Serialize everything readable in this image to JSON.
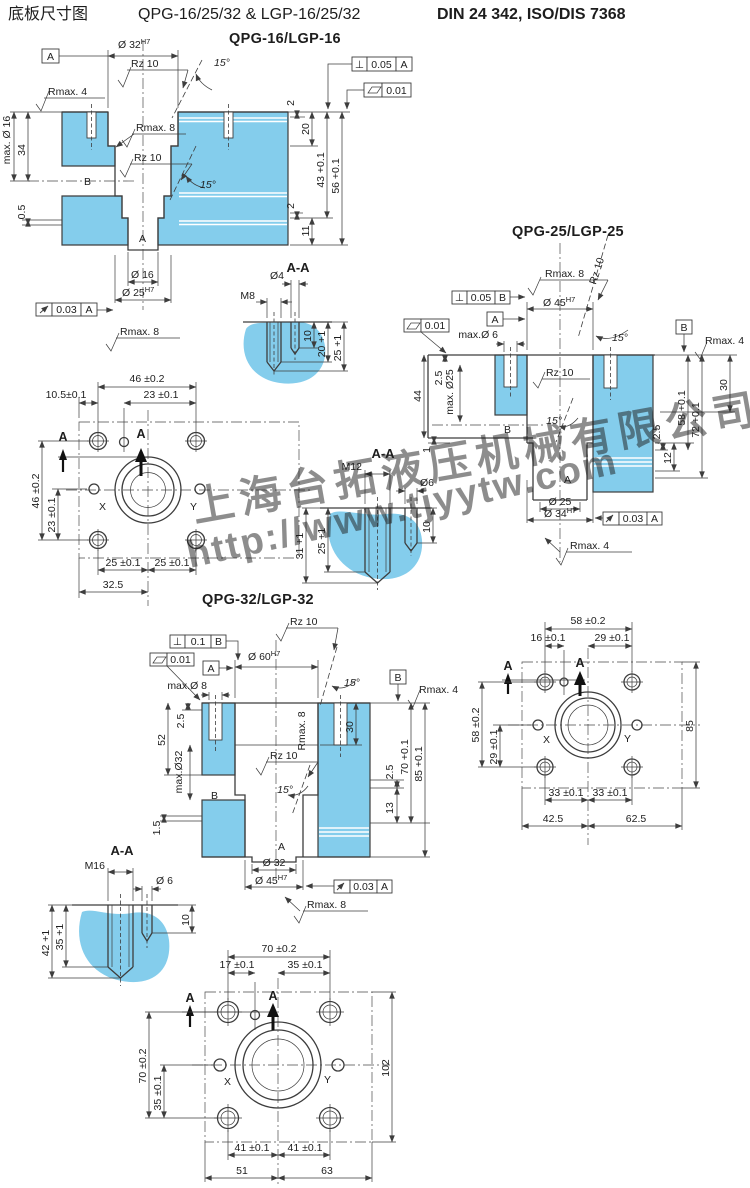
{
  "header": {
    "title_cn": "底板尺寸图",
    "models": "QPG-16/25/32 & LGP-16/25/32",
    "standard": "DIN 24 342, ISO/DIS 7368"
  },
  "watermark": {
    "company": "上海台拓液压机械有限公司",
    "url": "http://www.tjyytw.com"
  },
  "colors": {
    "section_fill": "#84cdec",
    "line": "#3d3d3d",
    "watermark": "#8db6e6"
  },
  "views": {
    "q16": {
      "heading": "QPG-16/LGP-16",
      "sec": {
        "datum_a": "A",
        "dia_top": "Ø 32",
        "dia_top_sup": "H7",
        "rz_top": "Rz 10",
        "ang_top": "15°",
        "rmax4": "Rmax. 4",
        "max_dia": "max. Ø 16",
        "d34": "34",
        "d05": "0.5",
        "datum_b": "B",
        "rmax8": "Rmax. 8",
        "rz_mid": "Rz 10",
        "ang_mid": "15°",
        "perp_sym": "⊥",
        "perp_val": "0.05",
        "perp_ref": "A",
        "flat_val": "0.01",
        "d2a": "2",
        "d20": "20",
        "d43": "43 +0.1",
        "d56": "56 +0.1",
        "d2b": "2",
        "d11": "11",
        "port_a": "A",
        "dia_16": "Ø 16",
        "dia_25": "Ø 25",
        "dia_25_sup": "H7",
        "run_val": "0.03",
        "run_ref": "A",
        "rmax8_b": "Rmax. 8"
      },
      "aa": {
        "title": "A-A",
        "dia": "Ø4",
        "thread": "M8",
        "d10": "10",
        "d20": "20 +1",
        "d25": "25 +1"
      },
      "fl": {
        "d_top": "46 ±0.2",
        "d_off": "10.5±0.1",
        "d_ctr": "23 ±0.1",
        "a1": "A",
        "a2": "A",
        "d_left": "46 ±0.2",
        "d_left2": "23 ±0.1",
        "x": "X",
        "y": "Y",
        "d_b1": "25 ±0.1",
        "d_b2": "25 ±0.1",
        "d_b3": "32.5"
      }
    },
    "q25": {
      "heading": "QPG-25/LGP-25",
      "sec": {
        "rmax8": "Rmax. 8",
        "rz_rot": "Rz 10",
        "perp_sym": "⊥",
        "perp_val": "0.05",
        "perp_ref": "B",
        "dia_top": "Ø 45",
        "dia_top_sup": "H7",
        "datum_a": "A",
        "flat_val": "0.01",
        "max_d6": "max.Ø 6",
        "ang_top": "15°",
        "datum_b_box": "B",
        "rmax4_r": "Rmax. 4",
        "d44": "44",
        "d25s": "2.5",
        "max_d25": "max. Ø25",
        "rz_mid": "Rz 10",
        "ang_mid": "15°",
        "datum_b": "B",
        "d1": "1",
        "d30": "30",
        "d25r": "2.5",
        "d12": "12",
        "d58": "58 +0.1",
        "d72": "72 +0.1",
        "port_a": "A",
        "dia_b1": "Ø 25",
        "dia_b2": "Ø 34",
        "dia_b2_sup": "H7",
        "run_val": "0.03",
        "run_ref": "A",
        "rmax4_b": "Rmax. 4"
      },
      "aa": {
        "title": "A-A",
        "thread": "M12",
        "dia": "Ø6",
        "d31": "31 +1",
        "d25": "25 +1",
        "d10": "10"
      },
      "fl": {
        "d_top": "58 ±0.2",
        "d_off": "16 ±0.1",
        "d_ctr": "29 ±0.1",
        "a1": "A",
        "a2": "A",
        "d_left": "58 ±0.2",
        "d_left2": "29 ±0.1",
        "x": "X",
        "y": "Y",
        "d_right": "85",
        "d_b1": "33 ±0.1",
        "d_b2": "33 ±0.1",
        "d_b3": "42.5",
        "d_b4": "62.5"
      }
    },
    "q32": {
      "heading": "QPG-32/LGP-32",
      "sec": {
        "rz_top": "Rz 10",
        "perp_sym": "⊥",
        "perp_val": "0.1",
        "perp_ref": "B",
        "dia_top": "Ø 60",
        "dia_top_sup": "H7",
        "datum_a": "A",
        "flat_val": "0.01",
        "max_d8": "max.Ø 8",
        "ang_top": "15°",
        "datum_b_box": "B",
        "rmax4": "Rmax. 4",
        "d25s": "2.5",
        "d52": "52",
        "max_d32": "max.Ø32",
        "d15": "1.5",
        "rmax8_rot": "Rmax. 8",
        "rz_mid": "Rz 10",
        "ang_mid": "15°",
        "datum_b": "B",
        "d30": "30",
        "d25r": "2.5",
        "d13": "13",
        "d70": "70 +0.1",
        "d85": "85 +0.1",
        "port_a": "A",
        "dia_b1": "Ø 32",
        "dia_b2": "Ø 45",
        "dia_b2_sup": "H7",
        "run_val": "0.03",
        "run_ref": "A",
        "rmax8_b": "Rmax. 8"
      },
      "aa": {
        "title": "A-A",
        "thread": "M16",
        "dia": "Ø 6",
        "d42": "42 +1",
        "d35": "35 +1",
        "d10": "10"
      },
      "fl": {
        "d_top": "70 ±0.2",
        "d_off": "17 ±0.1",
        "d_ctr": "35 ±0.1",
        "a1": "A",
        "a2": "A",
        "d_left": "70 ±0.2",
        "d_left2": "35 ±0.1",
        "x": "X",
        "y": "Y",
        "d_right": "102",
        "d_b1": "41 ±0.1",
        "d_b2": "41 ±0.1",
        "d_b3": "51",
        "d_b4": "63"
      }
    }
  }
}
